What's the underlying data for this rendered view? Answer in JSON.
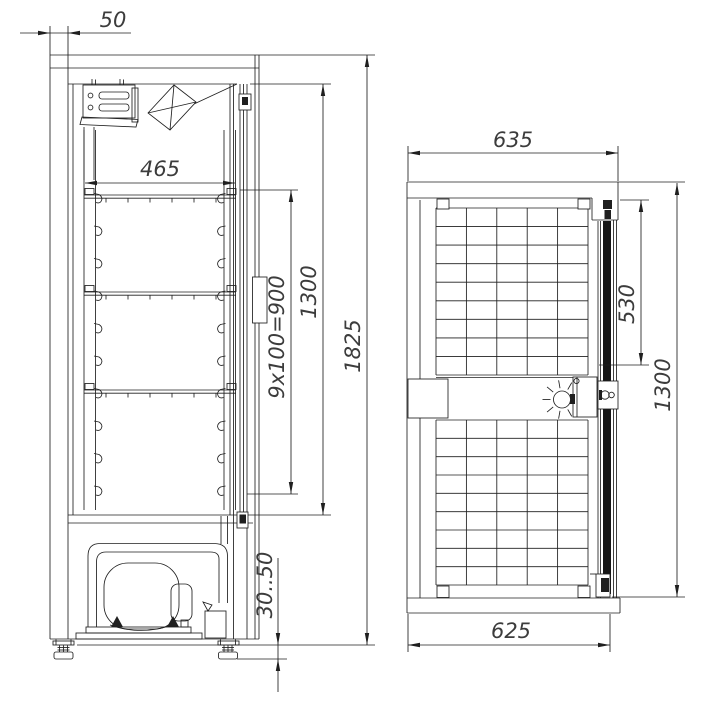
{
  "colors": {
    "line": "#1f1f1f",
    "background": "#ffffff",
    "door_seal": "#161616",
    "dim_text": "#3c3c3c"
  },
  "side_view": {
    "dim_wall_top": "50",
    "dim_shelf_width": "465",
    "dim_shelf_pitch": "9x100=900",
    "dim_interior_height": "1300",
    "dim_total_height": "1825",
    "dim_feet_adjust": "30..50"
  },
  "front_view": {
    "dim_top_width": "635",
    "dim_upper_section": "530",
    "dim_door_height": "1300",
    "dim_bottom_width": "625"
  }
}
